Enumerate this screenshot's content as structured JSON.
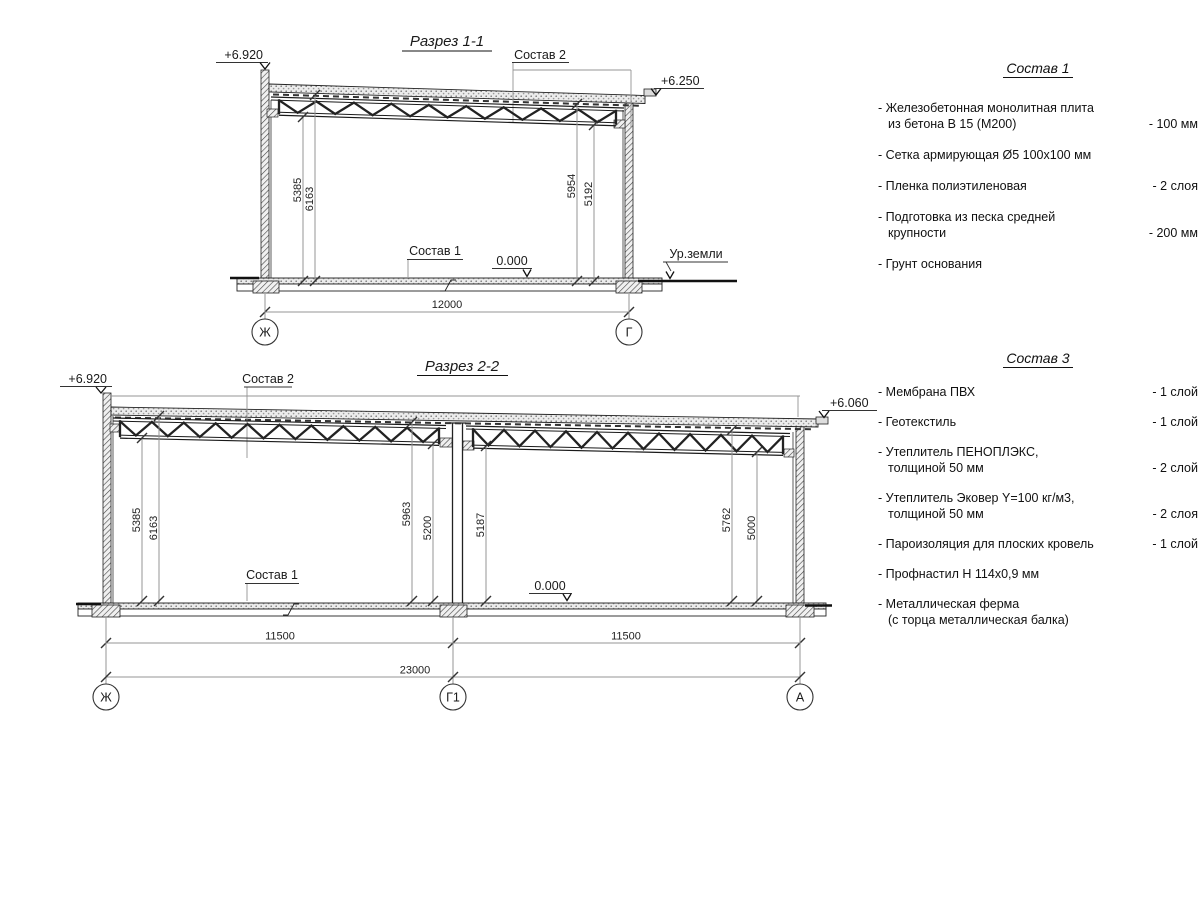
{
  "section1": {
    "title": "Разрез 1-1",
    "elev_left": "+6.920",
    "elev_right": "+6.250",
    "roof_label": "Состав 2",
    "floor_label": "Состав 1",
    "level_zero": "0.000",
    "ground_label": "Ур.земли",
    "vdims": [
      "5385",
      "6163",
      "5954",
      "5192"
    ],
    "span": "12000",
    "axis_left": "Ж",
    "axis_right": "Г"
  },
  "section2": {
    "title": "Разрез 2-2",
    "elev_left": "+6.920",
    "elev_right": "+6.060",
    "roof_label": "Состав 2",
    "floor_label": "Состав 1",
    "level_zero": "0.000",
    "vdims": [
      "5385",
      "6163",
      "5963",
      "5200",
      "5187",
      "5762",
      "5000"
    ],
    "spans": [
      "11500",
      "11500",
      "23000"
    ],
    "axes": [
      "Ж",
      "Г1",
      "А"
    ]
  },
  "panels": [
    {
      "title": "Состав 1",
      "items": [
        {
          "name": "- Железобетонная монолитная плита\nиз бетона В 15 (М200)",
          "value": "- 100 мм"
        },
        {
          "name": "- Сетка армирующая Ø5 100х100 мм",
          "value": ""
        },
        {
          "name": "- Пленка полиэтиленовая",
          "value": "- 2 слоя"
        },
        {
          "name": "- Подготовка из песка средней\nкрупности",
          "value": "- 200 мм"
        },
        {
          "name": "- Грунт основания",
          "value": ""
        }
      ]
    },
    {
      "title": "Состав 3",
      "items": [
        {
          "name": "- Мембрана ПВХ",
          "value": "- 1 слой"
        },
        {
          "name": "- Геотекстиль",
          "value": "- 1 слой"
        },
        {
          "name": "- Утеплитель ПЕНОПЛЭКС,\nтолщиной 50 мм",
          "value": "- 2 слой"
        },
        {
          "name": "- Утеплитель Эковер Y=100 кг/м3,\nтолщиной 50 мм",
          "value": "- 2 слоя"
        },
        {
          "name": "- Пароизоляция для плоских кровель",
          "value": "- 1 слой"
        },
        {
          "name": "- Профнастил Н 114х0,9 мм",
          "value": ""
        },
        {
          "name": "- Металлическая ферма\n(с торца металлическая балка)",
          "value": ""
        }
      ]
    }
  ]
}
